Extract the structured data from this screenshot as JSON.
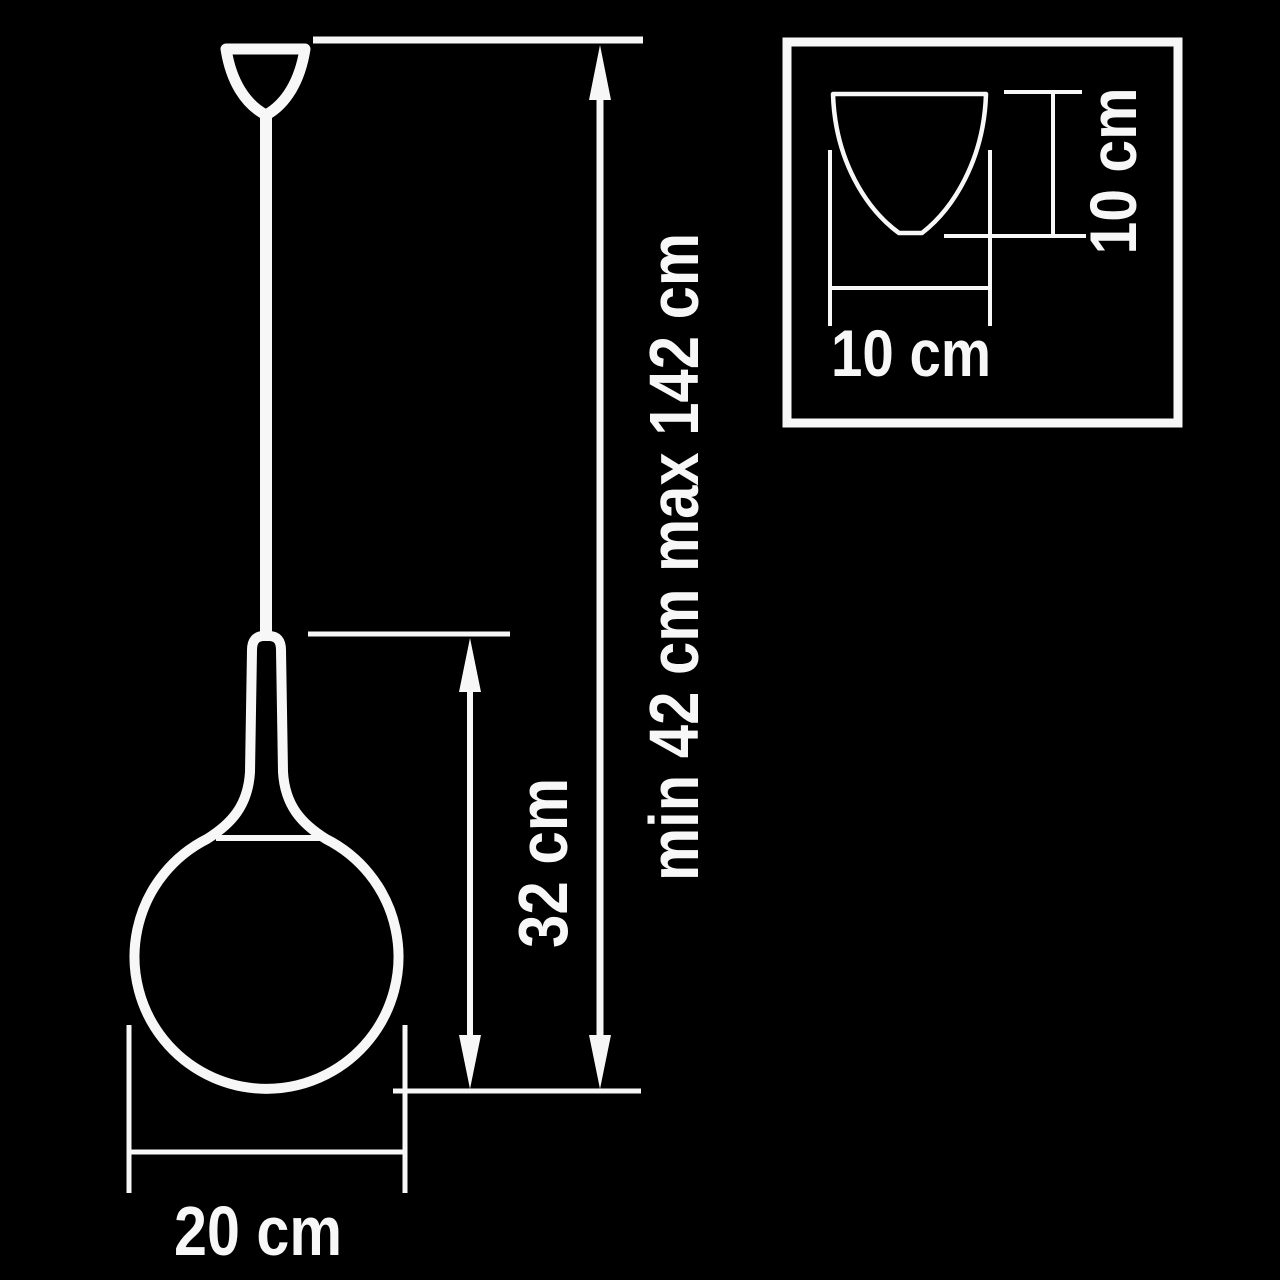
{
  "colors": {
    "background": "#000000",
    "line": "#f7f7f7"
  },
  "main_view": {
    "overall_height_label": "min 42 cm max 142 cm",
    "shade_height_label": "32 cm",
    "shade_diameter_label": "20 cm"
  },
  "inset_view": {
    "canopy_width_label": "10 cm",
    "canopy_height_label": "10 cm"
  }
}
